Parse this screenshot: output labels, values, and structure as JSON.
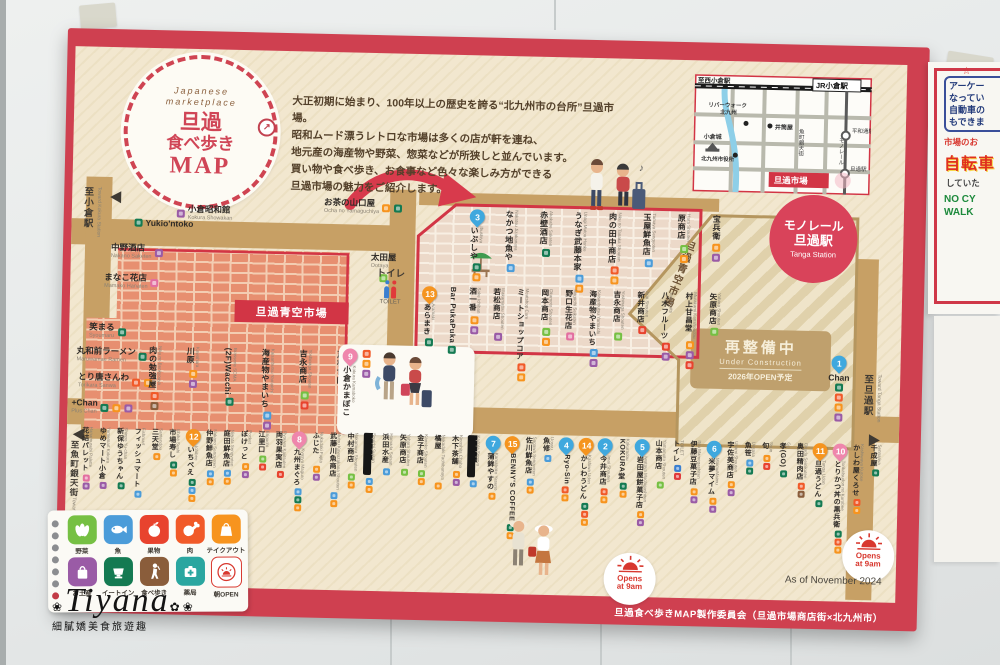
{
  "photo": {
    "watermark": {
      "name": "Tiyana",
      "caption": "細膩嬌美食旅遊趣"
    },
    "side_poster": {
      "star": "☆",
      "box_lines": [
        "アーケー",
        "なってい",
        "自動車の",
        "もできま"
      ],
      "line_red": "市場のお",
      "big_red": "自転車",
      "line_dark": "していた",
      "green_lines": [
        "NO CY",
        "WALK"
      ]
    }
  },
  "poster": {
    "logo": {
      "eyebrow1": "Japanese",
      "eyebrow2": "marketplace",
      "title1": "旦過",
      "title2": "食べ歩き",
      "title3": "MAP"
    },
    "intro": [
      "大正初期に始まり、100年以上の歴史を誇る“北九州市の台所”旦過市場。",
      "昭和ムード漂うレトロな市場は多くの店が軒を連ね、",
      "地元産の海産物や野菜、惣菜などが所狭しと並んでいます。",
      "買い物や食べ歩き、お食事など色々な楽しみ方ができる",
      "旦過市場の魅力をご紹介します。"
    ],
    "minimap": {
      "to_nishi": "至西小倉駅",
      "jr": "JR小倉駅",
      "riverwalk1": "リバーウォーク",
      "riverwalk2": "北九州",
      "izutsuya": "井筒屋",
      "castle": "小倉城",
      "cityhall": "北九州市役所",
      "uomachi": "魚町銀天街",
      "monorail": "モノレール",
      "heiwadori": "平和通駅",
      "tanga_eki": "旦過駅",
      "tanga_ichiba": "旦過市場"
    },
    "station": {
      "l1": "モノレール",
      "l2": "旦過駅",
      "en": "Tanga Station"
    },
    "aozora": "旦過青空市場",
    "aozora_vert": "旦過青空市場",
    "construction": {
      "l1": "再整備中",
      "l2": "Under Construction",
      "l3": "2026年OPEN予定"
    },
    "toilet": {
      "jp": "トイレ",
      "en": "TOILET"
    },
    "opens": {
      "l1": "Opens",
      "l2": "at 9am"
    },
    "dir_kokura": {
      "jp": "至小倉駅",
      "en": "Toward Kokura Station"
    },
    "dir_uomachi": {
      "jp": "至魚町銀天街",
      "en": "Toward Uomachi shopping street"
    },
    "dir_tanga": {
      "jp": "至旦過駅",
      "en": "Toward Tanga Station"
    },
    "as_of": "As of November 2024",
    "credit": "旦過食べ歩きMAP製作委員会（旦過市場商店街×北九州市）",
    "legend": {
      "row1": [
        {
          "label": "野菜",
          "type": "vegetable"
        },
        {
          "label": "魚",
          "type": "fish"
        },
        {
          "label": "果物",
          "type": "fruit"
        },
        {
          "label": "肉",
          "type": "meat"
        },
        {
          "label": "テイクアウト",
          "type": "takeout"
        }
      ],
      "row2": [
        {
          "label": "お土産",
          "type": "souvenir"
        },
        {
          "label": "イートイン",
          "type": "eatin"
        },
        {
          "label": "食べ歩き",
          "type": "tabearuki"
        },
        {
          "label": "薬局",
          "type": "pharmacy"
        },
        {
          "label": "朝OPEN",
          "type": "morning"
        }
      ]
    },
    "shops": {
      "left": [
        {
          "name": "Yukio'ntoko",
          "romaji": "",
          "icons": [
            "eatin"
          ]
        },
        {
          "name": "小倉昭和館",
          "romaji": "Kokura Showakan",
          "icons": [
            "souvenir"
          ]
        },
        {
          "name": "中野酒店",
          "romaji": "Nakano Saketen",
          "icons": [
            "souvenir"
          ]
        },
        {
          "name": "まなこ花店",
          "romaji": "Mamako Hanaten",
          "icons": [
            "flower"
          ]
        },
        {
          "name": "笑まる",
          "romaji": "Syoumaru",
          "icons": [
            "eatin"
          ]
        },
        {
          "name": "丸和前ラーメン",
          "romaji": "Maruwamae Ramen",
          "icons": [
            "eatin"
          ]
        },
        {
          "name": "とり唐さんわ",
          "romaji": "Torikara Sanwa",
          "icons": [
            "meat",
            "takeout"
          ]
        },
        {
          "name": "+Chan",
          "romaji": "Plus Chan",
          "icons": [
            "eatin",
            "takeout",
            "souvenir"
          ]
        }
      ],
      "ocha": {
        "name": "お茶の山口屋",
        "romaji": "Ocha no Yamaguchiya",
        "icons": [
          "takeout",
          "eatin"
        ]
      },
      "otaya": {
        "name": "太田屋",
        "romaji": "Ootaya",
        "icons": [
          "vegetable"
        ]
      },
      "mid": [
        {
          "name": "肉の勉強屋",
          "romaji": "Niku no Benkyouya",
          "icons": [
            "meat",
            "tabearuki"
          ]
        },
        {
          "name": "川原",
          "romaji": "Kawahara",
          "icons": [
            "takeout",
            "souvenir"
          ]
        },
        {
          "name": "(2F)Wacchi",
          "romaji": "Brasserie SOMA",
          "icons": [
            "eatin"
          ]
        },
        {
          "name": "海産物やまいち",
          "romaji": "Kaisanbutsu Yamaichi",
          "icons": [
            "fish",
            "souvenir"
          ]
        },
        {
          "name": "吉永商店",
          "romaji": "Yoshinaga Shouten",
          "icons": [
            "vegetable",
            "fruit"
          ]
        },
        {
          "name": "戸根食肉",
          "romaji": "Tone Syokuniku",
          "icons": [
            "meat"
          ]
        }
      ],
      "kamaboko": {
        "name": "小倉かまぼこ",
        "romaji": "Kokura Kamaboko",
        "icons": [
          "meat",
          "takeout",
          "souvenir"
        ],
        "pin": {
          "n": 9,
          "color": "pink"
        }
      },
      "chan": {
        "name": "Chan",
        "romaji": "",
        "icons": [
          "eatin",
          "meat",
          "takeout",
          "souvenir"
        ],
        "pin": {
          "n": 1,
          "color": "blue"
        }
      },
      "market_row1": [
        {
          "name": "いぶしや",
          "romaji": "Ibushiya",
          "icons": [
            "eatin",
            "takeout"
          ],
          "pin": {
            "n": 3,
            "color": "blue"
          }
        },
        {
          "name": "なかつ地魚や",
          "romaji": "Nakatsu Jizakanaya",
          "icons": [
            "fish"
          ]
        },
        {
          "name": "赤壁酒店",
          "romaji": "Akakabe Saketen",
          "icons": [
            "eatin"
          ]
        },
        {
          "name": "うなぎ武藤本家",
          "romaji": "Unagi Mutou Honke",
          "icons": [
            "fish",
            "takeout"
          ]
        },
        {
          "name": "肉の田中商店",
          "romaji": "Niku no Tanaka Shouten",
          "icons": [
            "meat",
            "takeout"
          ]
        },
        {
          "name": "玉屋鮮魚店",
          "romaji": "Tamaya Sengyoten",
          "icons": [
            "fish"
          ]
        },
        {
          "name": "原商店",
          "romaji": "Hara Shouten",
          "icons": [
            "vegetable",
            "takeout"
          ]
        },
        {
          "name": "宝兵衛",
          "romaji": "",
          "icons": [
            "takeout",
            "souvenir"
          ]
        }
      ],
      "market_row2": [
        {
          "name": "あらまき",
          "romaji": "Aramaki",
          "icons": [
            "eatin"
          ],
          "pin": {
            "n": 13,
            "color": "orange"
          }
        },
        {
          "name": "Bar PukaPuka",
          "romaji": "",
          "icons": [
            "eatin"
          ]
        },
        {
          "name": "酒一番",
          "romaji": "Sake Ichiban",
          "icons": [
            "takeout",
            "souvenir"
          ]
        },
        {
          "name": "若松商店",
          "romaji": "Wakamatsu Shouten",
          "icons": [
            "souvenir"
          ]
        },
        {
          "name": "ミートショップコア",
          "romaji": "Meatshop Core",
          "icons": [
            "meat",
            "takeout"
          ]
        },
        {
          "name": "岡本商店",
          "romaji": "Okamoto Shouten",
          "icons": [
            "vegetable",
            "takeout"
          ]
        },
        {
          "name": "野口生花店",
          "romaji": "Noguchi Seikaten",
          "icons": [
            "flower"
          ]
        },
        {
          "name": "海産物やまいち",
          "romaji": "Kaisanbutsu Yamaichi",
          "icons": [
            "fish",
            "souvenir"
          ]
        },
        {
          "name": "吉永商店",
          "romaji": "Yoshinaga Shouten",
          "icons": [
            "vegetable"
          ]
        },
        {
          "name": "新井商店",
          "romaji": "Arai Shouten",
          "icons": [
            "fruit"
          ]
        },
        {
          "name": "八木フルーツ",
          "romaji": "Yagi Fruits",
          "icons": [
            "fruit",
            "souvenir"
          ]
        },
        {
          "name": "村上甘昌堂",
          "romaji": "Murakami Kanshoudou",
          "icons": [
            "takeout",
            "souvenir",
            "fruit"
          ]
        },
        {
          "name": "矢原商店",
          "romaji": "Yahara Shouten",
          "icons": [
            "vegetable"
          ]
        }
      ],
      "bottom": [
        {
          "name": "花結パレット",
          "romaji": "Hanamusubi Palette",
          "icons": [
            "flower",
            "souvenir"
          ]
        },
        {
          "name": "ゆめマート小倉",
          "romaji": "Yumemart Kokura",
          "icons": [
            "souvenir"
          ]
        },
        {
          "name": "新保ゆうちゃん",
          "romaji": "Shinpo Yu-chan",
          "icons": [
            "eatin"
          ]
        },
        {
          "name": "フィッシュマート",
          "romaji": "Fishmart",
          "icons": [
            "fish"
          ]
        },
        {
          "name": "三天堂",
          "romaji": "Santendou",
          "icons": [
            "takeout"
          ]
        },
        {
          "name": "市場寿し",
          "romaji": "Ichiba Sushi",
          "icons": [
            "eatin",
            "takeout"
          ]
        },
        {
          "name": "いちべえ",
          "romaji": "Ichibee",
          "icons": [
            "eatin",
            "fish",
            "takeout"
          ],
          "pin": {
            "n": 12,
            "color": "orange"
          }
        },
        {
          "name": "仲野鮮魚店",
          "romaji": "Nakano Sengyoten",
          "icons": [
            "fish",
            "takeout"
          ]
        },
        {
          "name": "庭田鮮魚店",
          "romaji": "Niwata Sengyoten",
          "icons": [
            "fish",
            "takeout"
          ]
        },
        {
          "name": "ぽけっと",
          "romaji": "Pocket",
          "icons": [
            "takeout",
            "souvenir"
          ]
        },
        {
          "name": "江里口",
          "romaji": "Eriguchi",
          "icons": [
            "vegetable",
            "fruit"
          ]
        },
        {
          "name": "両羽果実店",
          "romaji": "Ryouwa Kajitsuten",
          "icons": [
            "fruit"
          ]
        },
        {
          "name": "九州まぐろ",
          "romaji": "Kyusyu Maguro",
          "icons": [
            "fish",
            "eatin",
            "takeout"
          ],
          "pin": {
            "n": 8,
            "color": "pink"
          }
        },
        {
          "name": "ふじた",
          "romaji": "Nukadaki Fujita",
          "icons": [
            "takeout",
            "souvenir"
          ]
        },
        {
          "name": "武藤川魚商店",
          "romaji": "Mutou Kawazakana Shouten",
          "icons": [
            "fish",
            "takeout"
          ]
        },
        {
          "name": "中村商店",
          "romaji": "Nakamura Shouten",
          "icons": [
            "vegetable",
            "takeout"
          ]
        },
        {
          "name": "█████",
          "romaji": "Souichi Suisan",
          "redacted": true,
          "icons": [
            "fish",
            "takeout"
          ]
        },
        {
          "name": "浜田水産",
          "romaji": "Hamada Suisan",
          "icons": [
            "fish"
          ]
        },
        {
          "name": "矢原商店",
          "romaji": "Yahara Shouten",
          "icons": [
            "vegetable"
          ]
        },
        {
          "name": "金子商店",
          "romaji": "Kaneko Shouten",
          "icons": [
            "vegetable",
            "takeout"
          ]
        },
        {
          "name": "橘屋",
          "romaji": "Nukadaki Tachibanaya",
          "icons": [
            "takeout"
          ]
        },
        {
          "name": "木下茶舗",
          "romaji": "Kinoshita Chaho",
          "icons": [
            "takeout",
            "souvenir"
          ]
        },
        {
          "name": "█████",
          "romaji": "Kadota Sengyo",
          "redacted": true,
          "icons": [
            "fish"
          ]
        },
        {
          "name": "蒲鉾やすの",
          "romaji": "Kamaboko Yasuno",
          "icons": [
            "takeout"
          ],
          "pin": {
            "n": 7,
            "color": "blue"
          }
        },
        {
          "name": "BENNY'S COFFEE",
          "romaji": "",
          "icons": [
            "eatin",
            "takeout"
          ],
          "pin": {
            "n": 15,
            "color": "orange"
          }
        },
        {
          "name": "佐川鮮魚店",
          "romaji": "Sagawa Sengyoten",
          "icons": [
            "fish",
            "takeout"
          ]
        },
        {
          "name": "魚修",
          "romaji": "Uosyu",
          "icons": [
            "fish"
          ]
        },
        {
          "name": "Ryo-Sin",
          "romaji": "",
          "icons": [
            "meat",
            "takeout"
          ],
          "pin": {
            "n": 4,
            "color": "blue"
          }
        },
        {
          "name": "かしわうどん",
          "romaji": "Kashiwa Udon",
          "icons": [
            "eatin",
            "meat",
            "takeout"
          ],
          "pin": {
            "n": 14,
            "color": "orange"
          }
        },
        {
          "name": "今井商店",
          "romaji": "Imai Shouten",
          "icons": [
            "meat",
            "takeout"
          ],
          "pin": {
            "n": 2,
            "color": "blue"
          }
        },
        {
          "name": "KOKURA堂",
          "romaji": "Kokuradou",
          "icons": [
            "eatin",
            "takeout"
          ]
        },
        {
          "name": "岩田屋餅菓子店",
          "romaji": "Iwataya Mochigashiten",
          "icons": [
            "takeout",
            "souvenir"
          ],
          "pin": {
            "n": 5,
            "color": "blue"
          }
        },
        {
          "name": "山本商店",
          "romaji": "Yamamoto Shouten",
          "icons": [
            "vegetable"
          ]
        },
        {
          "name": "トイレ",
          "romaji": "TOILET",
          "icons": [
            "wc-male",
            "wc-female"
          ]
        },
        {
          "name": "伊藤豆菓子店",
          "romaji": "Itou Mamegashiten",
          "icons": [
            "takeout",
            "souvenir"
          ]
        },
        {
          "name": "米夢マイム",
          "romaji": "MaimuMaimu",
          "icons": [
            "takeout",
            "souvenir"
          ],
          "pin": {
            "n": 6,
            "color": "blue"
          }
        },
        {
          "name": "宇佐美商店",
          "romaji": "Usami Shouten",
          "icons": [
            "takeout",
            "souvenir"
          ]
        },
        {
          "name": "魚笹",
          "romaji": "Uosasa",
          "icons": [
            "fish",
            "eatin"
          ]
        },
        {
          "name": "旬",
          "romaji": "Syun",
          "icons": [
            "takeout",
            "fruit"
          ]
        },
        {
          "name": "孝(GO)",
          "romaji": "Go",
          "icons": [
            "eatin"
          ]
        },
        {
          "name": "奥田精肉店",
          "romaji": "Okuda Seinikuten",
          "icons": [
            "meat",
            "tabearuki"
          ]
        },
        {
          "name": "旦過うどん",
          "romaji": "Tanga Udon",
          "icons": [
            "eatin"
          ],
          "pin": {
            "n": 11,
            "color": "orange"
          }
        },
        {
          "name": "とりかつ丼の黒兵衛",
          "romaji": "Torikatsudon no Kurobee",
          "icons": [
            "eatin",
            "meat",
            "takeout"
          ],
          "pin": {
            "n": 10,
            "color": "pink"
          }
        },
        {
          "name": "かしわ屋くろせ",
          "romaji": "Kashiwaya Kurose",
          "icons": [
            "meat",
            "takeout"
          ]
        },
        {
          "name": "千成屋",
          "romaji": "Sennariya",
          "icons": [
            "eatin"
          ]
        }
      ]
    }
  }
}
